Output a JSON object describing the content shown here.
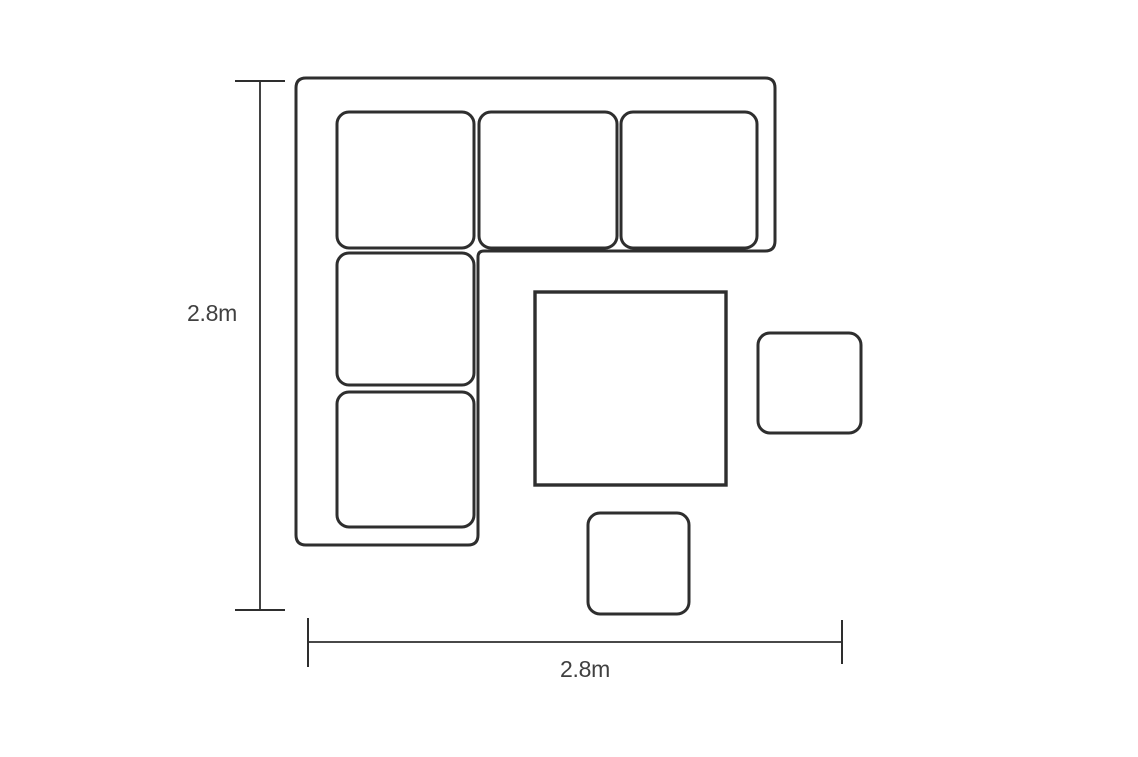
{
  "diagram": {
    "kind": "furniture-dimension-floor-plan",
    "labels": {
      "height": "2.8m",
      "width": "2.8m"
    },
    "pieces": [
      {
        "id": "corner-sofa",
        "description": "L-shaped corner sofa outline with 5 seat cushions"
      },
      {
        "id": "square-table",
        "description": "large square table"
      },
      {
        "id": "stool-right",
        "description": "small square stool on right"
      },
      {
        "id": "stool-bottom",
        "description": "small square stool at bottom"
      }
    ],
    "colors": {
      "line": "#2e2e2e",
      "text": "#404040",
      "background": "#ffffff"
    }
  }
}
